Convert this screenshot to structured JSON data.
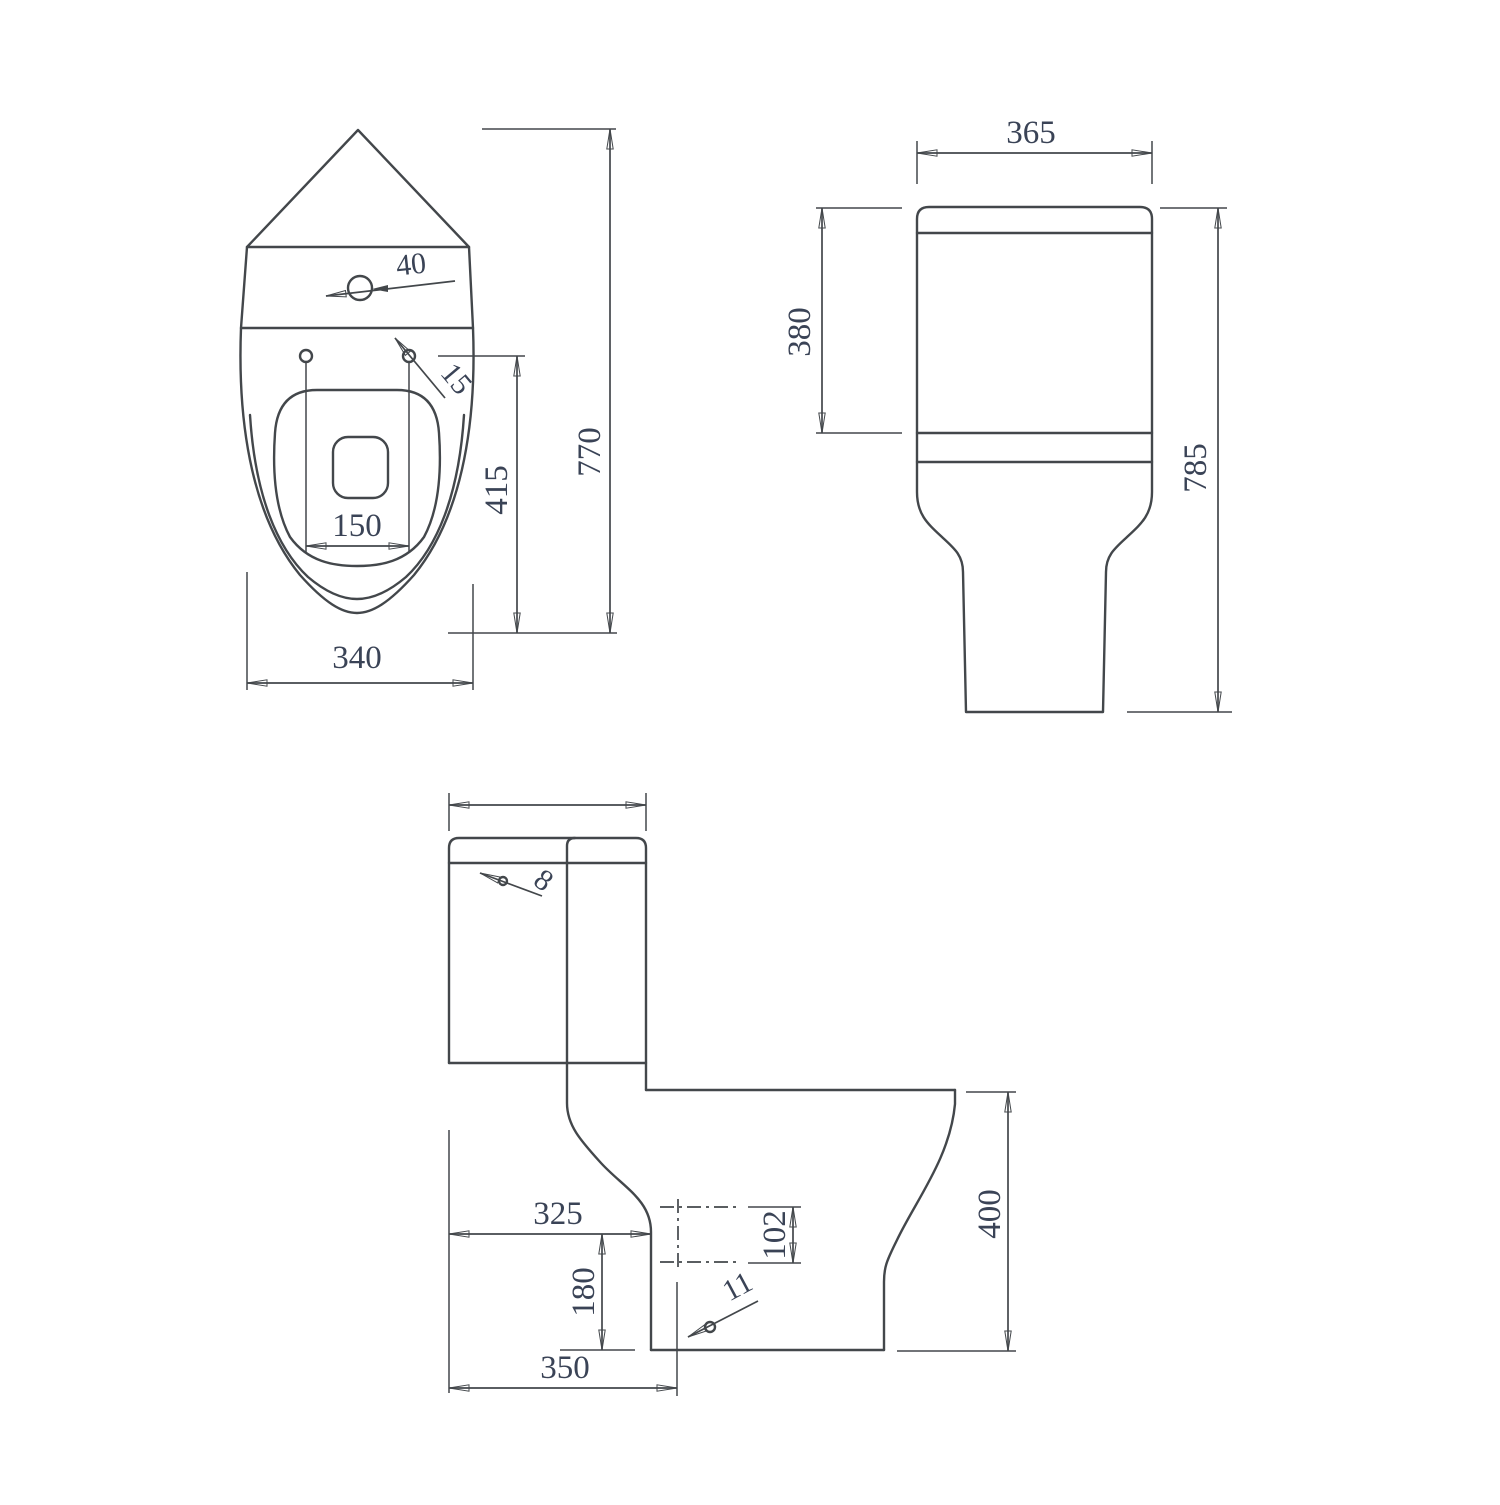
{
  "drawing": {
    "kind": "technical dimension drawing",
    "subject": "corner close-coupled toilet, three orthographic views",
    "units_implied": "mm",
    "views": {
      "plan": {
        "name": "top (plan) view",
        "dims": {
          "hole_diameter": "40",
          "seat_fixing_hole": "15",
          "overall_depth": "770",
          "seat_hole_to_front": "415",
          "seat_hole_spacing": "150",
          "bowl_width": "340"
        }
      },
      "front": {
        "name": "front view",
        "dims": {
          "cistern_width": "365",
          "cistern_height": "380",
          "overall_height": "785"
        }
      },
      "side": {
        "name": "side view",
        "dims": {
          "lid_fixing_hole": "8",
          "outlet_setout": "325",
          "outlet_bore": "102",
          "outlet_centre_height": "180",
          "floor_fixing_hole": "11",
          "base_depth": "350",
          "rim_height": "400"
        }
      }
    }
  }
}
